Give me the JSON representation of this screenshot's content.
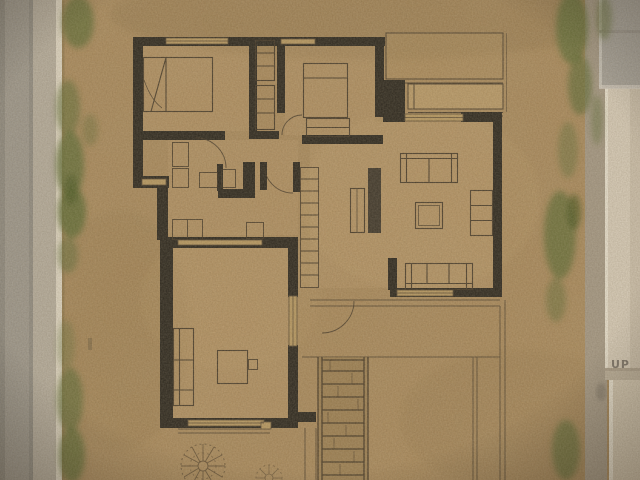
{
  "scene": {
    "title": "top-down architectural floor plan rendered on sandy lot",
    "neighbor_stamp": "UP",
    "palette": {
      "dirt": "#a9885a",
      "wall": "#25211a",
      "line": "#3b3022",
      "window_sill": "#b69760",
      "road": "#9b968d",
      "sidewalk": "#b4ac9e",
      "curb": "#ded6c5",
      "path": "#a39785",
      "slab": "#a5a19a",
      "building": "#d7ccba",
      "building_lower": "#d2c6b1",
      "grass": "#5c6a33",
      "stair": "#8f7549",
      "deck": "#bfa06c",
      "stamp": "#5a534c",
      "tv_dark": "#2b2721"
    },
    "spaces": [
      "bedroom-northwest",
      "wardrobe-closet",
      "bedroom-north",
      "hallway",
      "bathroom",
      "corridor-with-shelf",
      "living-room",
      "studio-room",
      "north-deck",
      "south-patio",
      "garden-stairs",
      "yard",
      "street-west",
      "neighbor-building-east"
    ],
    "furniture": [
      "double-bed",
      "single-bed",
      "closet-shelves",
      "sink-boxes",
      "storage-bench",
      "tall-shelf",
      "two-seat-sofa",
      "coffee-table",
      "sideboard",
      "three-seat-sofa",
      "tv-console",
      "daybed-sofa",
      "work-table",
      "chair",
      "large-garden-tree",
      "small-garden-tree"
    ]
  }
}
